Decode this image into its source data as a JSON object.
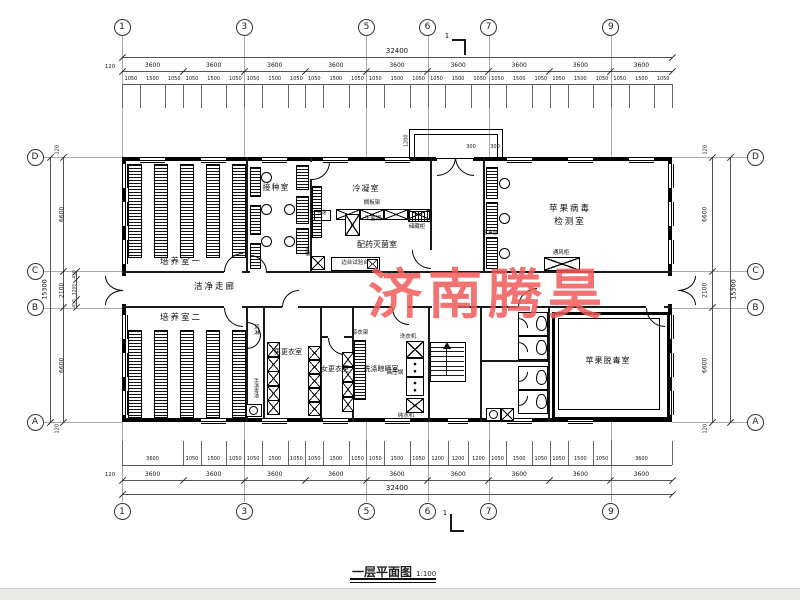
{
  "watermark": {
    "text": "济南腾昊",
    "color": "#f15a5a"
  },
  "title": {
    "text": "一层平面图",
    "scale": "1:100"
  },
  "grid": {
    "top_columns": [
      "1",
      "3",
      "5",
      "6",
      "7",
      "9"
    ],
    "bottom_columns": [
      "1",
      "3",
      "5",
      "6",
      "7",
      "9"
    ],
    "left_rows": [
      "D",
      "C",
      "B",
      "A"
    ],
    "right_rows": [
      "D",
      "C",
      "B",
      "A"
    ]
  },
  "dimensions": {
    "top": {
      "total": "32400",
      "edge": "120",
      "bays": [
        "3600",
        "3600",
        "3600",
        "3600",
        "3600",
        "3600",
        "3600",
        "3600",
        "3600"
      ],
      "detail_pattern": [
        "1050",
        "1500",
        "1050"
      ]
    },
    "bottom": {
      "total": "32400",
      "edge": "120",
      "bays": [
        "3600",
        "3600",
        "3600",
        "3600",
        "3600",
        "3600",
        "3600",
        "3600",
        "3600"
      ],
      "details": [
        "3600",
        "1050",
        "1500",
        "1050",
        "1050",
        "1500",
        "1050",
        "1050",
        "1500",
        "1050",
        "1050",
        "1500",
        "1050",
        "1200",
        "1200",
        "1200",
        "1050",
        "1500",
        "1050",
        "1050",
        "1500",
        "1050",
        "3600"
      ]
    },
    "left": {
      "total": "15300",
      "edge_top": "120",
      "edge_bottom": "120",
      "segments": [
        "6600",
        "2100",
        "6600"
      ],
      "sub": [
        "450",
        "1200",
        "450"
      ]
    },
    "right": {
      "total": "15300",
      "edge_top": "120",
      "edge_bottom": "120",
      "segments": [
        "6600",
        "2100",
        "6600"
      ]
    },
    "vestibule": [
      "1200",
      "300",
      "300"
    ]
  },
  "section_marks": {
    "top": "1",
    "bottom": "1"
  },
  "rooms": {
    "culture1": "培养室一",
    "culture2": "培养室二",
    "inoculation": "接种室",
    "condensation": "冷凝室",
    "medicine": "配药灭菌室",
    "corridor": "洁净走廊",
    "mens_changing": "男更衣室",
    "womens_changing": "女更衣室",
    "washing": "洗涤晾晒室",
    "virus_test_line1": "苹果病毒",
    "virus_test_line2": "检测室",
    "virus_free": "苹果脱毒室"
  },
  "equipment": {
    "shelf_rack": "搁板架",
    "sterilizer": "灭菌锅",
    "storage_cabinet": "储藏柜",
    "side_bench": "边台试验台",
    "pass_window": "传递",
    "sink": "水槽",
    "air_shower": "风淋",
    "hand_wash": "手消毒池",
    "clean_bench": "超净台",
    "fume_hood": "通风柜",
    "washer": "洗衣机",
    "drying_rack": "晾衣架",
    "autoclave": "高压锅",
    "water_purifier": "纯水机"
  }
}
